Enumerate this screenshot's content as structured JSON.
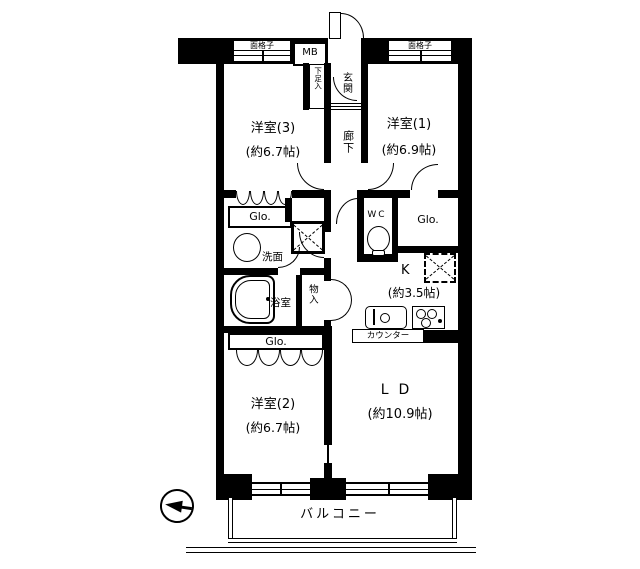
{
  "floorplan": {
    "rooms": {
      "western3": {
        "name": "洋室(3)",
        "size": "(約6.7帖)"
      },
      "western1": {
        "name": "洋室(1)",
        "size": "(約6.9帖)"
      },
      "western2": {
        "name": "洋室(2)",
        "size": "(約6.7帖)"
      },
      "living_dining": {
        "name": "LD",
        "size": "(約10.9帖)"
      },
      "kitchen": {
        "name": "K",
        "size": "(約3.5帖)"
      },
      "hallway": "廊下",
      "entrance": "玄関",
      "shoe_storage": "下足入",
      "washroom": "洗面",
      "bathroom": "浴室",
      "storage": "物入",
      "toilet": "WC",
      "balcony": "バルコニー"
    },
    "labels": {
      "closet": "Glo.",
      "meter_box": "MB",
      "window_grille": "面格子",
      "counter": "カウンター"
    },
    "colors": {
      "line": "#000000",
      "background": "#ffffff"
    }
  }
}
